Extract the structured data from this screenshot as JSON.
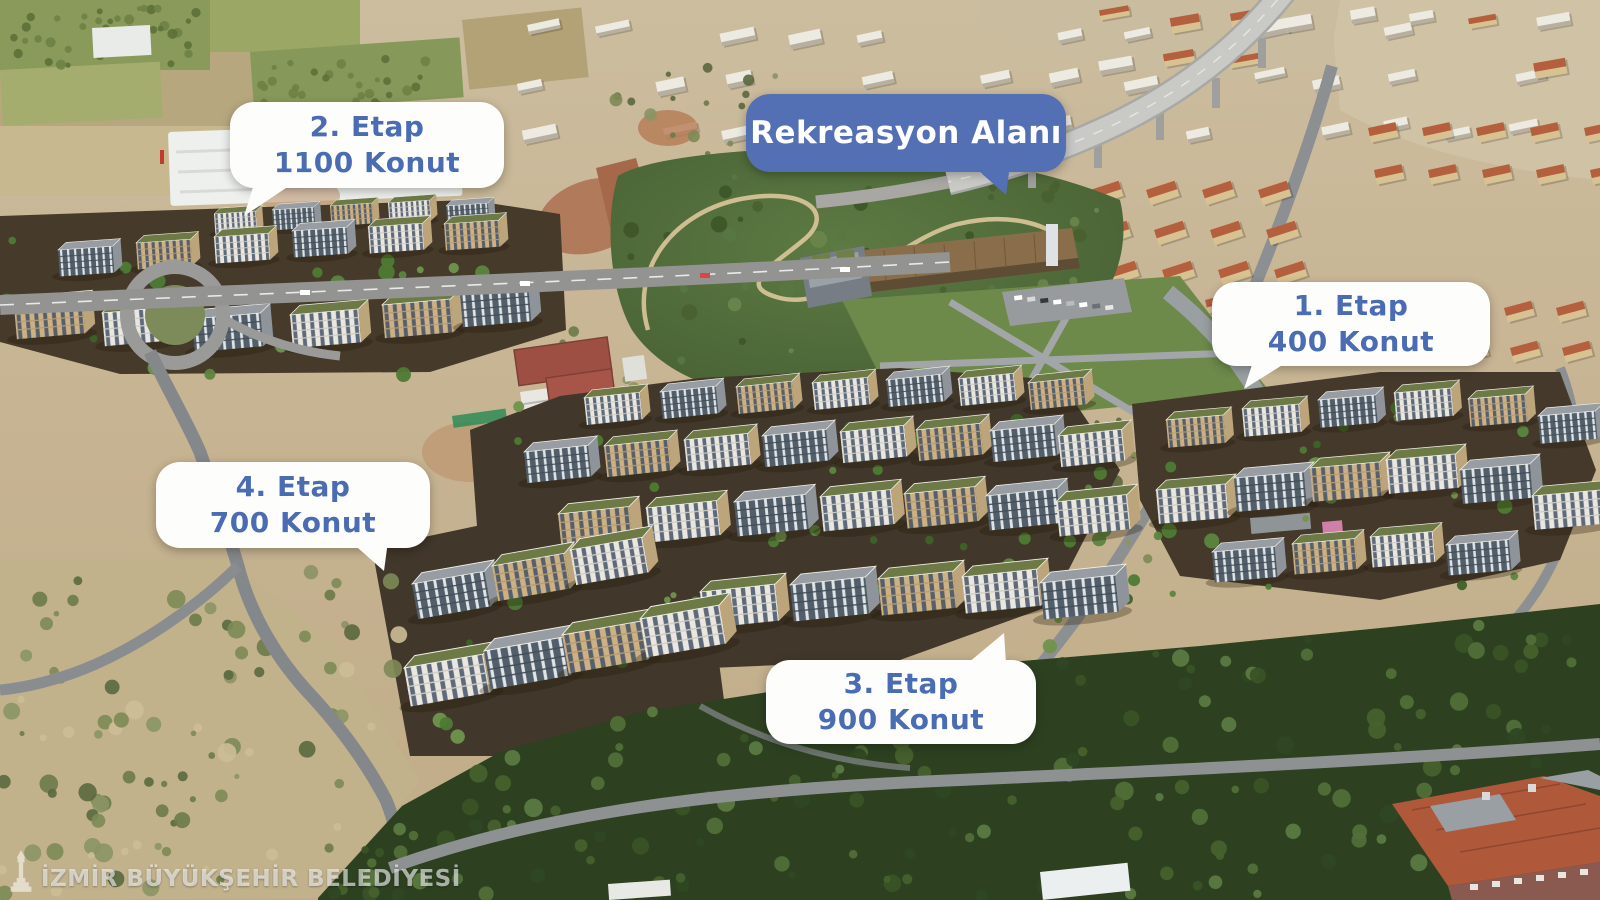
{
  "callouts": {
    "etap1": {
      "line1": "1. Etap",
      "line2": "400 Konut"
    },
    "etap2": {
      "line1": "2. Etap",
      "line2": "1100 Konut"
    },
    "etap3": {
      "line1": "3. Etap",
      "line2": "900 Konut"
    },
    "etap4": {
      "line1": "4. Etap",
      "line2": "700 Konut"
    },
    "recreation": {
      "label": "Rekreasyon Alanı"
    }
  },
  "watermark": {
    "text": "İZMİR BÜYÜKŞEHİR BELEDİYESİ",
    "icon": "izmir-clock-tower-icon"
  },
  "colors": {
    "bubble_white_bg": "#fdfdfc",
    "bubble_blue_bg": "#5470b4",
    "label_blue_text": "#4a6cb3",
    "label_white_text": "#ffffff"
  }
}
